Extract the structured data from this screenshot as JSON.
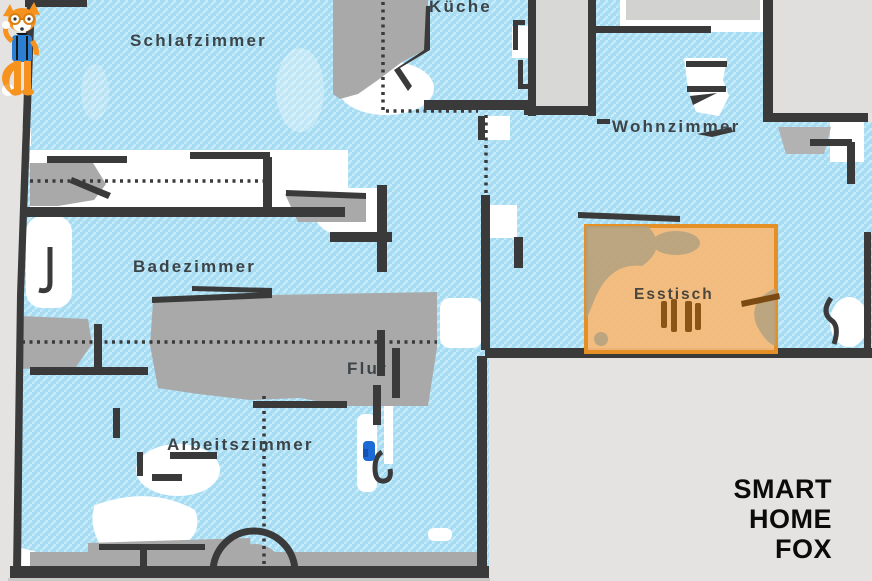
{
  "map": {
    "rooms": [
      {
        "id": "schlafzimmer",
        "label": "Schlafzimmer"
      },
      {
        "id": "kueche",
        "label": "Küche"
      },
      {
        "id": "wohnzimmer",
        "label": "Wohnzimmer"
      },
      {
        "id": "badezimmer",
        "label": "Badezimmer"
      },
      {
        "id": "flur",
        "label": "Flur"
      },
      {
        "id": "arbeitszimmer",
        "label": "Arbeitszimmer"
      }
    ],
    "zone": {
      "label": "Esstisch",
      "fill": "#f6ba79",
      "border": "#e59026"
    },
    "dock": {
      "color": "#1b6ad6"
    },
    "colors": {
      "outside": "#e4e3e1",
      "wall": "#3a3a3a",
      "floor": "#a6dbf2",
      "floor_hatch": "#c7ecfa",
      "furniture": "#a9a9a9",
      "unexplored": "#ffffff",
      "room_label": "#3d4447",
      "zone_text": "#4a463c",
      "zone_blob": "#b2a281",
      "table_legs": "#8a5416"
    }
  },
  "watermark": {
    "lines": [
      "SMART",
      "HOME",
      "FOX"
    ],
    "text_color": "#0b0b0b",
    "fox_orange": "#f6921e",
    "fox_blue": "#2d7fd3"
  }
}
